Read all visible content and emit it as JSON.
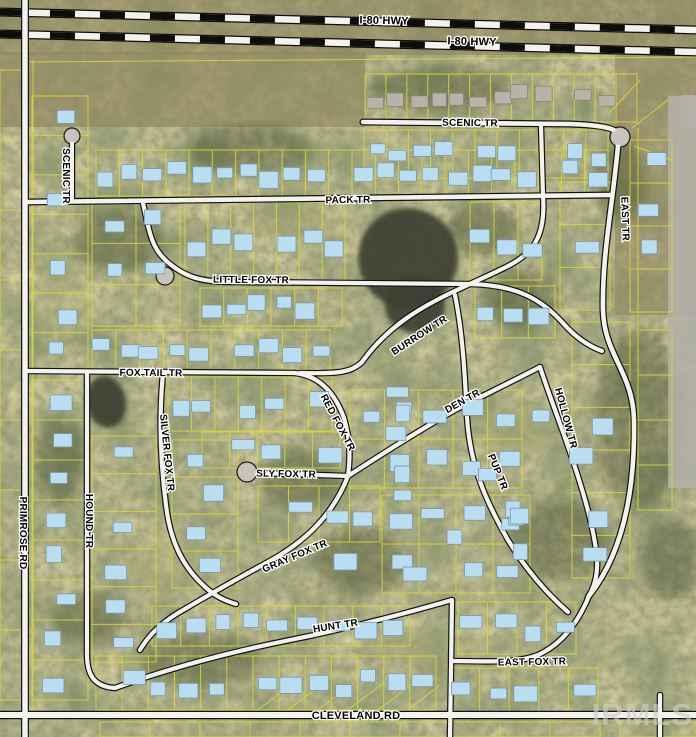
{
  "map": {
    "width": 696,
    "height": 737,
    "watermark": "IRMLS",
    "colors": {
      "parcel_line": "#d9d938",
      "road_fill": "#f2f2ee",
      "road_casing": "#111111",
      "building_fill": "#b9ddf1",
      "building_stroke": "#7e97a8",
      "roof_fill": "#b7b3a8",
      "roof_stroke": "#8a867c",
      "pond": "#3c4030",
      "pavement": "#b4b2aa"
    },
    "highways": [
      {
        "name": "i80-hwy-north",
        "x1": 0,
        "y1": 12,
        "x2": 696,
        "y2": 30
      },
      {
        "name": "i80-hwy-south",
        "x1": 0,
        "y1": 34,
        "x2": 696,
        "y2": 52
      }
    ],
    "roads": [
      {
        "name": "primrose-rd",
        "path": "M 25,0 L 25,737",
        "w": 5.5
      },
      {
        "name": "cleveland-rd",
        "path": "M 0,715 L 696,715",
        "w": 6
      },
      {
        "name": "pack-tr",
        "path": "M 28,202 L 610,195",
        "w": 4.6
      },
      {
        "name": "scenic-tr",
        "path": "M 363,122 L 570,124 C 600,125 618,128 620,136",
        "w": 4.6
      },
      {
        "name": "east-tr",
        "path": "M 618,146 C 612,210 602,255 603,310 C 604,355 633,372 634,420 C 635,480 627,548 589,596",
        "w": 4.6
      },
      {
        "name": "scenic-tr-west",
        "path": "M 72,143 L 72,198",
        "w": 4
      },
      {
        "name": "little-fox-tr",
        "path": "M 143,203 C 150,235 152,250 170,264 C 188,279 205,282 235,282 L 470,284 C 515,285 540,298 562,322 C 575,337 588,346 602,351",
        "w": 4.2
      },
      {
        "name": "burrow-tr",
        "path": "M 541,126 L 543,196 C 546,238 532,254 506,267 C 472,284 434,298 404,320 C 385,334 372,348 362,362 C 352,372 340,374 300,373",
        "w": 4.2
      },
      {
        "name": "fox-tail-tr",
        "path": "M 28,371 L 295,373",
        "w": 4.2
      },
      {
        "name": "red-fox-tr",
        "path": "M 295,373 C 320,376 335,393 344,418 C 351,442 350,460 348,476",
        "w": 4.2
      },
      {
        "name": "sly-fox-tr",
        "path": "M 258,473 L 348,476",
        "w": 4.2
      },
      {
        "name": "den-tr",
        "path": "M 348,476 C 385,452 420,430 455,410 C 490,392 515,380 540,367",
        "w": 4.2
      },
      {
        "name": "hollow-tr",
        "path": "M 540,367 C 549,395 561,425 572,458 C 584,494 594,528 597,558 C 598,576 594,588 588,597",
        "w": 4.2
      },
      {
        "name": "pup-tr",
        "path": "M 455,295 C 463,335 465,378 467,417 C 470,468 488,505 508,540 C 525,568 545,592 568,612",
        "w": 4.2
      },
      {
        "name": "gray-fox-tr",
        "path": "M 348,476 C 333,515 305,542 268,562 C 235,580 205,597 178,613 C 160,624 148,636 140,650",
        "w": 4.2
      },
      {
        "name": "silver-fox-tr",
        "path": "M 163,373 C 159,415 160,460 166,505 C 170,540 182,565 202,584 C 212,594 222,600 236,604",
        "w": 4.2
      },
      {
        "name": "hound-tr",
        "path": "M 87,373 L 87,655 C 87,678 97,687 115,688",
        "w": 4.2
      },
      {
        "name": "hunt-tr",
        "path": "M 115,688 C 170,668 230,652 290,640 C 340,630 400,615 452,600",
        "w": 4.2
      },
      {
        "name": "east-fox-tr",
        "path": "M 589,596 C 577,625 560,645 538,655 C 520,662 505,662 452,661",
        "w": 4.2
      },
      {
        "name": "east-fox-connector",
        "path": "M 452,600 L 450,737",
        "w": 4.2
      },
      {
        "name": "south-connector",
        "path": "M 660,695 L 660,737",
        "w": 4.2
      }
    ],
    "culdesacs": [
      {
        "x": 620,
        "y": 137,
        "r": 10
      },
      {
        "x": 247,
        "y": 472,
        "r": 10
      },
      {
        "x": 72,
        "y": 136,
        "r": 8
      },
      {
        "x": 165,
        "y": 276,
        "r": 9
      }
    ],
    "labels": [
      {
        "t": "I-80 HWY",
        "x": 384,
        "y": 24,
        "r": 1.4,
        "s": 11
      },
      {
        "t": "I-80 HWY",
        "x": 472,
        "y": 45,
        "r": 1.4,
        "s": 11
      },
      {
        "t": "SCENIC TR",
        "x": 470,
        "y": 126,
        "r": 0.8,
        "s": 10
      },
      {
        "t": "SCENIC TR",
        "x": 63,
        "y": 176,
        "r": 90,
        "s": 10
      },
      {
        "t": "PACK TR",
        "x": 348,
        "y": 203,
        "r": -0.8,
        "s": 10
      },
      {
        "t": "LITTLE FOX TR",
        "x": 251,
        "y": 283,
        "r": 0.5,
        "s": 10
      },
      {
        "t": "EAST TR",
        "x": 622,
        "y": 219,
        "r": 88,
        "s": 10
      },
      {
        "t": "BURROW TR",
        "x": 421,
        "y": 338,
        "r": -33,
        "s": 10
      },
      {
        "t": "FOX TAIL TR",
        "x": 151,
        "y": 376,
        "r": 0.5,
        "s": 10
      },
      {
        "t": "RED FOX TR",
        "x": 335,
        "y": 424,
        "r": 62,
        "s": 10
      },
      {
        "t": "DEN TR",
        "x": 464,
        "y": 404,
        "r": -29,
        "s": 10
      },
      {
        "t": "HOLLOW TR",
        "x": 563,
        "y": 419,
        "r": 75,
        "s": 10
      },
      {
        "t": "PUP TR",
        "x": 495,
        "y": 473,
        "r": 68,
        "s": 10
      },
      {
        "t": "SILVER FOX TR",
        "x": 164,
        "y": 453,
        "r": 84,
        "s": 10
      },
      {
        "t": "HOUND TR",
        "x": 86,
        "y": 521,
        "r": 90,
        "s": 10
      },
      {
        "t": "SLY FOX TR",
        "x": 286,
        "y": 477,
        "r": 1,
        "s": 10
      },
      {
        "t": "GRAY FOX TR",
        "x": 296,
        "y": 559,
        "r": -23,
        "s": 10
      },
      {
        "t": "HUNT TR",
        "x": 336,
        "y": 629,
        "r": -9,
        "s": 10
      },
      {
        "t": "EAST FOX TR",
        "x": 532,
        "y": 665,
        "r": -1,
        "s": 10
      },
      {
        "t": "PRIMROSE RD",
        "x": 20,
        "y": 533,
        "r": 90,
        "s": 10
      },
      {
        "t": "CLEVELAND RD",
        "x": 356,
        "y": 719,
        "r": 0,
        "s": 11
      }
    ],
    "ponds": [
      {
        "cx": 408,
        "cy": 258,
        "rx": 50,
        "ry": 50,
        "rot": 15
      },
      {
        "cx": 415,
        "cy": 305,
        "rx": 30,
        "ry": 28,
        "rot": 0
      },
      {
        "cx": 106,
        "cy": 402,
        "rx": 20,
        "ry": 26,
        "rot": -10
      }
    ],
    "woods": [
      {
        "cx": 250,
        "cy": 150,
        "rx": 60,
        "ry": 25
      },
      {
        "cx": 120,
        "cy": 240,
        "rx": 45,
        "ry": 30
      },
      {
        "cx": 520,
        "cy": 300,
        "rx": 40,
        "ry": 30
      },
      {
        "cx": 640,
        "cy": 420,
        "rx": 45,
        "ry": 90
      },
      {
        "cx": 560,
        "cy": 540,
        "rx": 50,
        "ry": 40
      },
      {
        "cx": 300,
        "cy": 480,
        "rx": 40,
        "ry": 30
      },
      {
        "cx": 200,
        "cy": 660,
        "rx": 60,
        "ry": 25
      },
      {
        "cx": 480,
        "cy": 230,
        "rx": 35,
        "ry": 25
      },
      {
        "cx": 360,
        "cy": 560,
        "rx": 45,
        "ry": 35
      },
      {
        "cx": 620,
        "cy": 180,
        "rx": 25,
        "ry": 40
      },
      {
        "cx": 90,
        "cy": 620,
        "rx": 35,
        "ry": 25
      },
      {
        "cx": 670,
        "cy": 560,
        "rx": 30,
        "ry": 40
      },
      {
        "cx": 440,
        "cy": 90,
        "rx": 70,
        "ry": 22
      },
      {
        "cx": 60,
        "cy": 460,
        "rx": 25,
        "ry": 45
      }
    ],
    "grass": [
      {
        "cx": 300,
        "cy": 220,
        "rx": 50,
        "ry": 30
      },
      {
        "cx": 160,
        "cy": 560,
        "rx": 40,
        "ry": 30
      },
      {
        "cx": 520,
        "cy": 430,
        "rx": 40,
        "ry": 25
      },
      {
        "cx": 430,
        "cy": 650,
        "rx": 50,
        "ry": 20
      },
      {
        "cx": 60,
        "cy": 300,
        "rx": 25,
        "ry": 40
      }
    ],
    "tints": [
      {
        "x": 0,
        "y": 0,
        "w": 696,
        "h": 55,
        "fill": "#8a8158",
        "op": 0.55
      },
      {
        "x": 0,
        "y": 52,
        "w": 365,
        "h": 75,
        "fill": "#90875f",
        "op": 0.7
      },
      {
        "x": 615,
        "y": 55,
        "w": 81,
        "h": 260,
        "fill": "#8f8660",
        "op": 0.6
      }
    ],
    "pavement": [
      {
        "x": 668,
        "y": 96,
        "w": 28,
        "h": 392
      },
      {
        "x": 681,
        "y": 95,
        "w": 15,
        "h": 34
      }
    ],
    "parcel_blocks": [
      {
        "x": 365,
        "y": 74,
        "w": 272,
        "h": 48,
        "cols": 13,
        "rows": 1,
        "type": "roof"
      },
      {
        "x": 364,
        "y": 130,
        "w": 244,
        "h": 48,
        "cols": 11,
        "rows": 1
      },
      {
        "x": 96,
        "y": 150,
        "w": 512,
        "h": 46,
        "cols": 22,
        "rows": 1
      },
      {
        "x": 32,
        "y": 96,
        "w": 56,
        "h": 276,
        "cols": 1,
        "rows": 7
      },
      {
        "x": 32,
        "y": 380,
        "w": 56,
        "h": 320,
        "cols": 1,
        "rows": 8
      },
      {
        "x": 92,
        "y": 202,
        "w": 88,
        "h": 124,
        "cols": 2,
        "rows": 3
      },
      {
        "x": 185,
        "y": 202,
        "w": 160,
        "h": 78,
        "cols": 7,
        "rows": 1
      },
      {
        "x": 470,
        "y": 202,
        "w": 72,
        "h": 78,
        "cols": 3,
        "rows": 1
      },
      {
        "x": 200,
        "y": 288,
        "w": 142,
        "h": 38,
        "cols": 6,
        "rows": 1
      },
      {
        "x": 475,
        "y": 286,
        "w": 80,
        "h": 52,
        "cols": 3,
        "rows": 1
      },
      {
        "x": 92,
        "y": 330,
        "w": 238,
        "h": 40,
        "cols": 10,
        "rows": 1
      },
      {
        "x": 168,
        "y": 377,
        "w": 164,
        "h": 54,
        "cols": 7,
        "rows": 1
      },
      {
        "x": 92,
        "y": 436,
        "w": 64,
        "h": 226,
        "cols": 1,
        "rows": 6
      },
      {
        "x": 172,
        "y": 440,
        "w": 66,
        "h": 148,
        "cols": 1,
        "rows": 4
      },
      {
        "x": 202,
        "y": 432,
        "w": 138,
        "h": 36,
        "cols": 5,
        "rows": 1
      },
      {
        "x": 258,
        "y": 486,
        "w": 122,
        "h": 56,
        "cols": 4,
        "rows": 1
      },
      {
        "x": 350,
        "y": 390,
        "w": 172,
        "h": 98,
        "cols": 5,
        "rows": 2
      },
      {
        "x": 382,
        "y": 495,
        "w": 148,
        "h": 98,
        "cols": 4,
        "rows": 2
      },
      {
        "x": 572,
        "y": 322,
        "w": 58,
        "h": 256,
        "cols": 1,
        "rows": 6
      },
      {
        "x": 560,
        "y": 182,
        "w": 50,
        "h": 128,
        "cols": 1,
        "rows": 3
      },
      {
        "x": 630,
        "y": 140,
        "w": 42,
        "h": 172,
        "cols": 1,
        "rows": 4
      },
      {
        "x": 638,
        "y": 330,
        "w": 34,
        "h": 180,
        "cols": 1,
        "rows": 4,
        "nb": true
      },
      {
        "x": 152,
        "y": 606,
        "w": 258,
        "h": 40,
        "cols": 9,
        "rows": 1
      },
      {
        "x": 96,
        "y": 656,
        "w": 340,
        "h": 54,
        "cols": 13,
        "rows": 1
      },
      {
        "x": 458,
        "y": 602,
        "w": 118,
        "h": 52,
        "cols": 4,
        "rows": 1
      },
      {
        "x": 450,
        "y": 668,
        "w": 148,
        "h": 44,
        "cols": 5,
        "rows": 1
      },
      {
        "x": 100,
        "y": 722,
        "w": 500,
        "h": 15,
        "cols": 10,
        "rows": 1,
        "nb": true
      },
      {
        "x": 620,
        "y": 722,
        "w": 76,
        "h": 15,
        "cols": 2,
        "rows": 1,
        "nb": true
      },
      {
        "x": 0,
        "y": 70,
        "w": 22,
        "h": 630,
        "cols": 1,
        "rows": 9,
        "nb": true
      }
    ],
    "extra_lines": [
      "M 30,62 L 696,57",
      "M 33,60 L 33,715",
      "M 638,128 L 638,330",
      "M 632,128 L 668,100",
      "M 634,146 L 672,160",
      "M 610,112 L 640,80",
      "M 255,712 L 295,682",
      "M 285,712 L 325,682",
      "M 315,712 L 355,682",
      "M 345,712 L 385,682",
      "M 375,712 L 415,682",
      "M 405,712 L 440,685"
    ],
    "scatter_buildings": {
      "x": 345,
      "y": 385,
      "w": 255,
      "h": 210,
      "count": 16
    }
  }
}
